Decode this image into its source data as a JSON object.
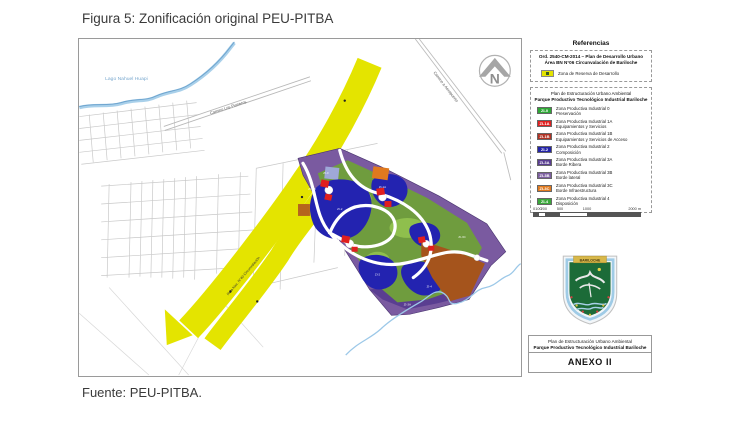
{
  "page": {
    "title": "Figura 5: Zonificación original PEU-PITBA",
    "source": "Fuente: PEU-PITBA."
  },
  "colors": {
    "band-yellow": "#e4e400",
    "zone-purple": "#7a5aa0",
    "zone-purple-dark": "#5a3e91",
    "zone-olive": "#6f9c3e",
    "zone-green": "#8fbf4d",
    "zone-navy": "#2323b0",
    "zone-red": "#e01f1f",
    "zone-brown": "#a5541c",
    "zone-orange": "#e0791e",
    "zone-periwinkle": "#9fa8d8",
    "water": "#8ebfe0",
    "street": "#c9c9c9"
  },
  "map": {
    "lake_label": "Lago Nahuel Huapi",
    "road_pioneros": "Camino Los Pioneros",
    "road_airport": "Camino a Aeropuerto",
    "road_ring": "Ruta Nac. N°40 Circunvalación",
    "compass": "N",
    "zone_labels": [
      "ZI-0",
      "ZI-2",
      "ZI-1A",
      "ZI-3B",
      "ZI-2",
      "ZI-4",
      "ZI-3A",
      "ZI-3C"
    ]
  },
  "legend": {
    "title": "Referencias",
    "pdu_box": {
      "line1": "Ord. 2540-CM-2014 – Plan de Desarrollo Urbano",
      "line2": "Área BN N°06  Circunvalación de Bariloche",
      "item_label": "Zona de Reserva de Desarrollo",
      "item_color": "#e4e400"
    },
    "peu_box": {
      "header1": "Plan de Estructuración Urbano Ambiental",
      "header2": "Parque Productivo Tecnológico Industrial Bariloche",
      "items": [
        {
          "code": "ZI-0",
          "color": "#2ea836",
          "desc1": "Zona Productiva Industrial 0",
          "desc2": "Preservación"
        },
        {
          "code": "ZI-1A",
          "color": "#e02020",
          "desc1": "Zona Productiva Industrial 1A",
          "desc2": "Equipamientos y Servicios"
        },
        {
          "code": "ZI-1B",
          "color": "#b03224",
          "desc1": "Zona Productiva Industrial 1B",
          "desc2": "Equipamientos y Servicios de Acceso"
        },
        {
          "code": "ZI-2",
          "color": "#2424a8",
          "desc1": "Zona Productiva Industrial 2",
          "desc2": "Composición"
        },
        {
          "code": "ZI-3A",
          "color": "#5a3e91",
          "desc1": "Zona Productiva Industrial 3A",
          "desc2": "Borde Ribera"
        },
        {
          "code": "ZI-3B",
          "color": "#7d5fa0",
          "desc1": "Zona Productiva Industrial 3B",
          "desc2": "Borde lateral"
        },
        {
          "code": "ZI-3C",
          "color": "#e0791e",
          "desc1": "Zona Productiva Industrial 3C",
          "desc2": "Borde Infraestructura"
        },
        {
          "code": "ZI-4",
          "color": "#3aa83a",
          "desc1": "Zona Productiva Industrial 4",
          "desc2": "Disposición"
        }
      ]
    },
    "scale": {
      "ticks": [
        "0",
        "100",
        "200",
        "500",
        "1000",
        "2000 m"
      ]
    }
  },
  "titleblock": {
    "line1": "Plan de Estructuración Urbano Ambiental",
    "line2": "Parque Productivo Tecnológico Industrial Bariloche",
    "annex": "ANEXO II",
    "shield_banner": "BARILOCHE"
  }
}
